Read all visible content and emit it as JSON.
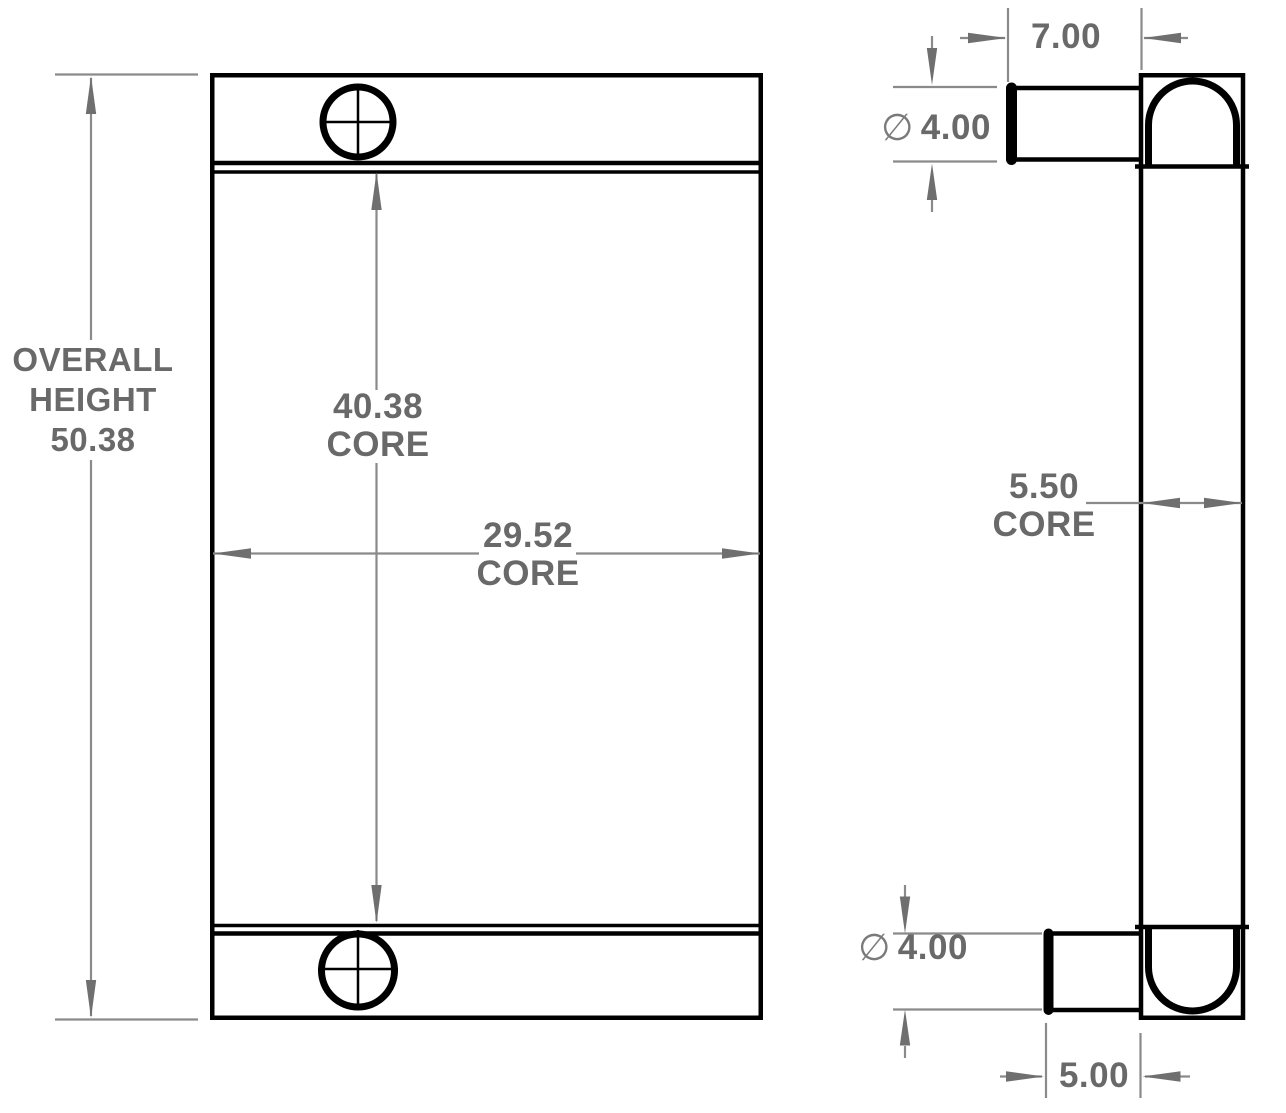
{
  "drawing": {
    "title": "heat-exchanger-two-view-dimension-drawing",
    "front_view": {
      "overall_height": {
        "line1": "OVERALL",
        "line2": "HEIGHT",
        "value": "50.38"
      },
      "core_height": {
        "value": "40.38",
        "label": "CORE"
      },
      "core_width": {
        "value": "29.52",
        "label": "CORE"
      }
    },
    "side_view": {
      "overall_depth": {
        "value": "7.00"
      },
      "top_port": {
        "diameter_symbol": "∅",
        "value": "4.00"
      },
      "core_depth": {
        "value": "5.50",
        "label": "CORE"
      },
      "bottom_port": {
        "diameter_symbol": "∅",
        "value": "4.00"
      },
      "port_protrusion": {
        "value": "5.00"
      }
    },
    "colors": {
      "background": "#ffffff",
      "part_outline": "#000000",
      "dimension_line": "#8a8a8a",
      "arrowhead": "#6f6f6f",
      "dimension_text": "#696969"
    }
  }
}
